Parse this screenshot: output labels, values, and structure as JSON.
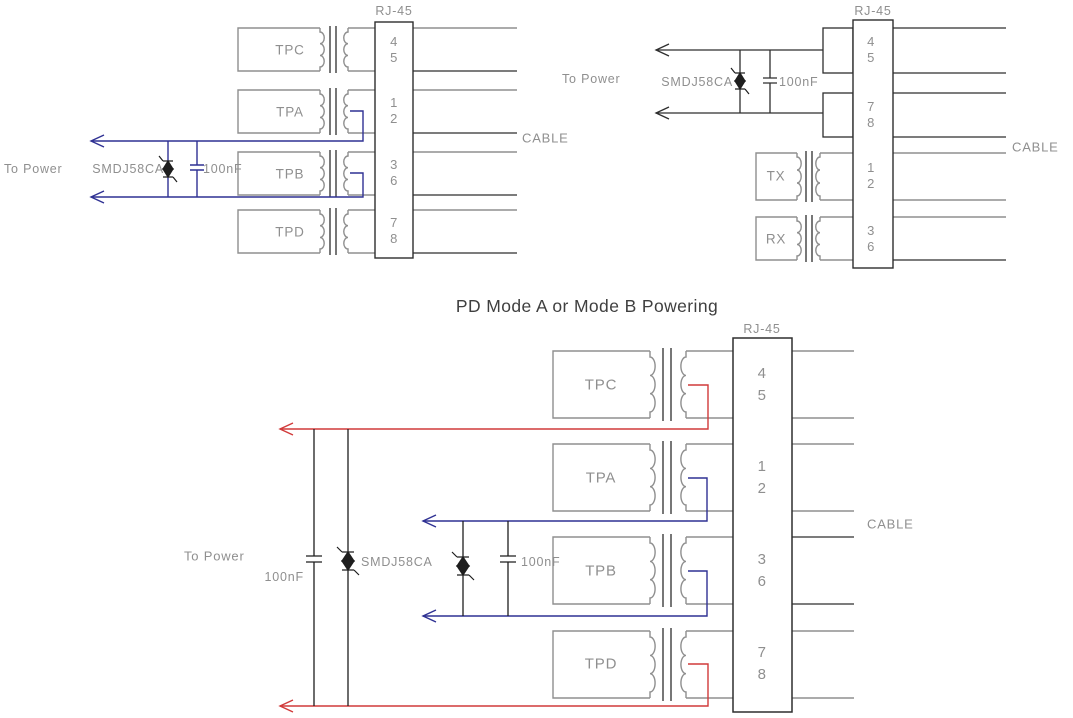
{
  "title": "PD Mode A or Mode B Powering",
  "colors": {
    "wire_gray": "#8f8f8f",
    "wire_black": "#2e2e2e",
    "power_blue": "#2f3193",
    "power_red": "#d13a3a",
    "label_gray": "#8f8f8f",
    "title_dark": "#3f3f3f"
  },
  "top_left": {
    "rj45_label": "RJ-45",
    "cable_label": "CABLE",
    "to_power_label": "To Power",
    "tvs_label": "SMDJ58CA",
    "cap_label": "100nF",
    "blocks": [
      "TPC",
      "TPA",
      "TPB",
      "TPD"
    ],
    "pins": [
      "4",
      "5",
      "1",
      "2",
      "3",
      "6",
      "7",
      "8"
    ]
  },
  "top_right": {
    "rj45_label": "RJ-45",
    "cable_label": "CABLE",
    "to_power_label": "To Power",
    "tvs_label": "SMDJ58CA",
    "cap_label": "100nF",
    "blocks": [
      "TX",
      "RX"
    ],
    "pins": [
      "4",
      "5",
      "7",
      "8",
      "1",
      "2",
      "3",
      "6"
    ]
  },
  "bottom": {
    "rj45_label": "RJ-45",
    "cable_label": "CABLE",
    "to_power_label": "To Power",
    "tvs_label": "SMDJ58CA",
    "cap_left_label": "100nF",
    "cap_right_label": "100nF",
    "blocks": [
      "TPC",
      "TPA",
      "TPB",
      "TPD"
    ],
    "pins": [
      "4",
      "5",
      "1",
      "2",
      "3",
      "6",
      "7",
      "8"
    ]
  }
}
